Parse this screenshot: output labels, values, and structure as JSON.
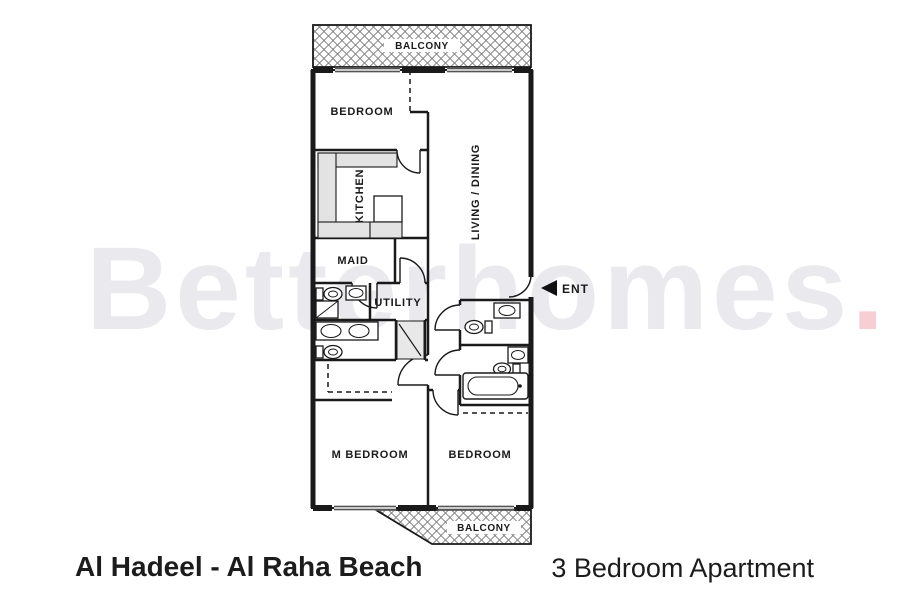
{
  "watermark": {
    "text": "Betterhomes",
    "dot": "."
  },
  "colors": {
    "wall": "#1a1a1a",
    "hatch": "#6f6f6f",
    "watermark": "#e9e9ee",
    "watermark_dot": "#f6ced3",
    "counter_fill": "#e3e3e3",
    "shaft_fill": "#e8e8e8"
  },
  "plan": {
    "labels": {
      "balcony_top": "BALCONY",
      "bedroom_top": "BEDROOM",
      "kitchen": "KITCHEN",
      "living_dining": "LIVING / DINING",
      "maid": "MAID",
      "utility": "UTILITY",
      "ent": "ENT",
      "m_bedroom": "M BEDROOM",
      "bedroom_bottom": "BEDROOM",
      "balcony_bottom": "BALCONY"
    }
  },
  "footer": {
    "left_title": "Al Hadeel - Al Raha Beach",
    "right_title": "3 Bedroom Apartment"
  }
}
